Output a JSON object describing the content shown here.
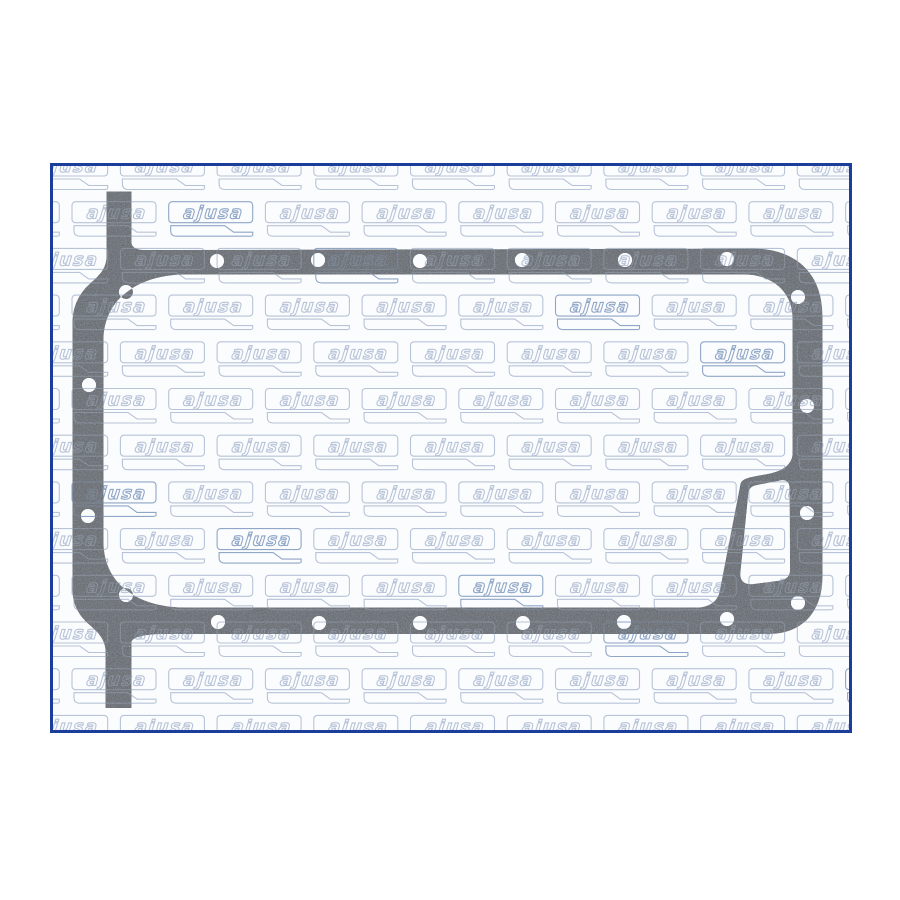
{
  "page": {
    "background": "#ffffff"
  },
  "frame": {
    "x": 50,
    "y": 163,
    "width": 802,
    "height": 570,
    "border_color": "#1c3e9b",
    "border_width": 3,
    "background": "#fbfcfe"
  },
  "watermark": {
    "text": "ajusa",
    "stroke_light": "#b7c3d7",
    "stroke_dark": "#8fa6c6",
    "row_pitch": 46.7,
    "col_pitch": 96.7,
    "first_row_y": 155,
    "even_phase": 23.7,
    "odd_phase": 72,
    "overlay_opacity_on_gasket": 0.3
  },
  "gasket": {
    "description": "oil-pan-gasket",
    "base_color": "#75797f",
    "speck_dark": "#393c44",
    "speck_light": "#9da1aa",
    "hole_radius": 7,
    "holes": [
      [
        217,
        261
      ],
      [
        318,
        260
      ],
      [
        420,
        261
      ],
      [
        522,
        260
      ],
      [
        625,
        260
      ],
      [
        727,
        259
      ],
      [
        798,
        297
      ],
      [
        807,
        406
      ],
      [
        807,
        513
      ],
      [
        798,
        603
      ],
      [
        727,
        619
      ],
      [
        624,
        622
      ],
      [
        523,
        623
      ],
      [
        420,
        623
      ],
      [
        319,
        623
      ],
      [
        218,
        622
      ],
      [
        126,
        595
      ],
      [
        88,
        516
      ],
      [
        89,
        385
      ],
      [
        126,
        292
      ]
    ]
  }
}
